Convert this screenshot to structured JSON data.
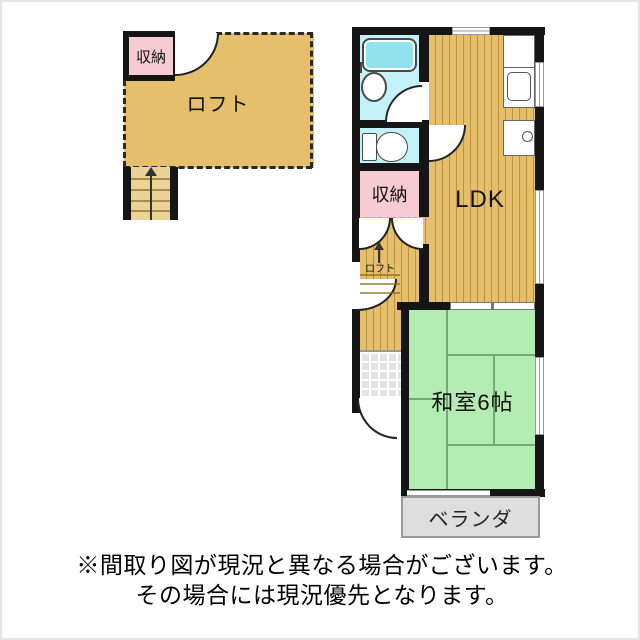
{
  "floorplan": {
    "loft_area": {
      "room_label": "ロフト",
      "closet_label": "収納"
    },
    "main_floor": {
      "storage_label": "収納",
      "ldk_label": "LDK",
      "japanese_room_label": "和室6帖",
      "veranda_label": "ベランダ",
      "loft_ladder_label": "ロフト"
    },
    "disclaimer": {
      "line1": "※間取り図が現況と異なる場合がございます。",
      "line2": "その場合には現況優先となります。"
    },
    "colors": {
      "wood_floor": "#E5BF6B",
      "tatami_green": "#B4EDB4",
      "wet_area_cyan": "#C3F1F8",
      "closet_pink": "#F6CBD1",
      "veranda_gray": "#DEDEDE",
      "wall_black": "#151515"
    }
  }
}
